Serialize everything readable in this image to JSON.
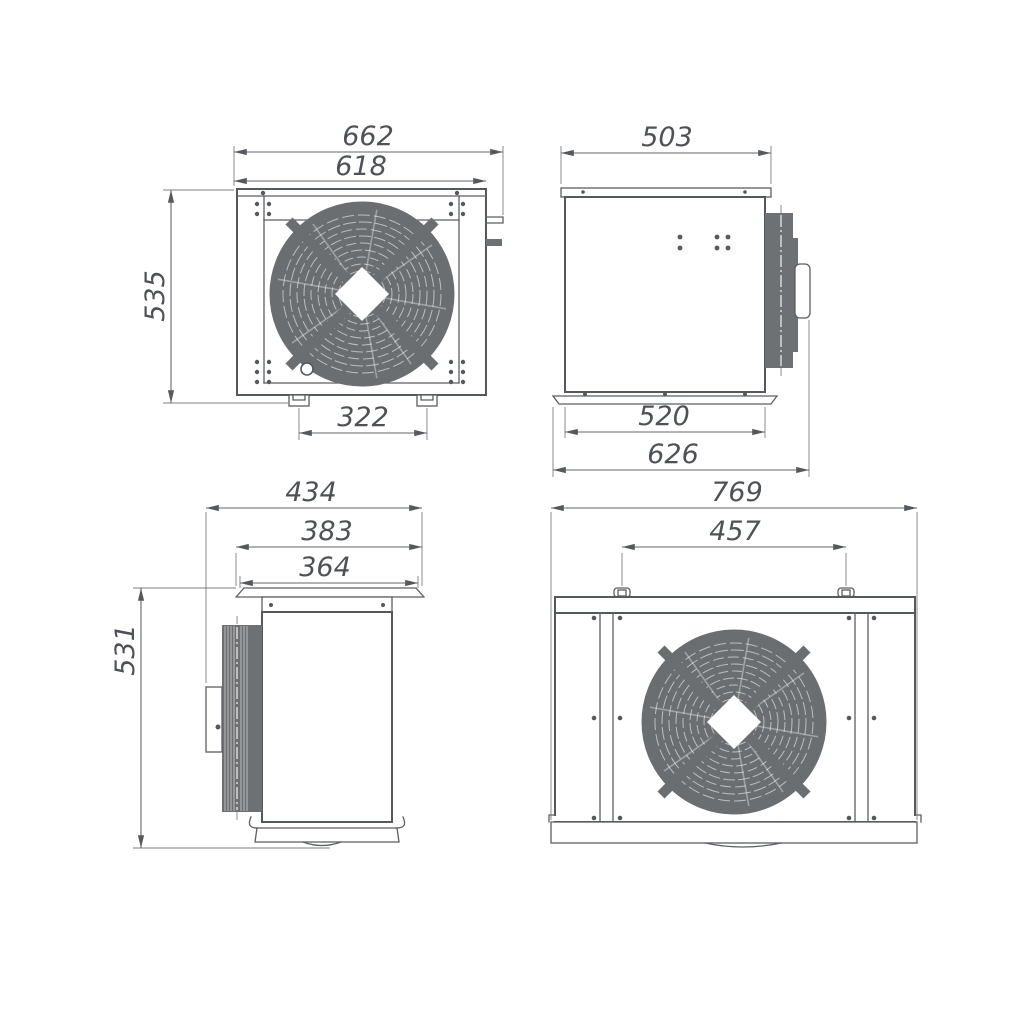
{
  "meta": {
    "drawing_type": "orthographic technical drawing, condensing unit with axial fan",
    "background_color": "#ffffff",
    "line_color": "#55585c",
    "fill_gray": "#6e7174",
    "text_color": "#4e5256"
  },
  "views": {
    "front": {
      "dims": {
        "overall_width": "662",
        "body_width": "618",
        "overall_height": "535",
        "feet_spacing": "322"
      }
    },
    "right_side": {
      "dims": {
        "top_width": "503",
        "base_width": "520",
        "overall_depth": "626"
      }
    },
    "left_side": {
      "dims": {
        "overall_depth": "434",
        "flange_width": "383",
        "top_plate_width": "364",
        "overall_height": "531"
      }
    },
    "rear": {
      "dims": {
        "overall_width": "769",
        "bracket_spacing": "457"
      }
    }
  }
}
